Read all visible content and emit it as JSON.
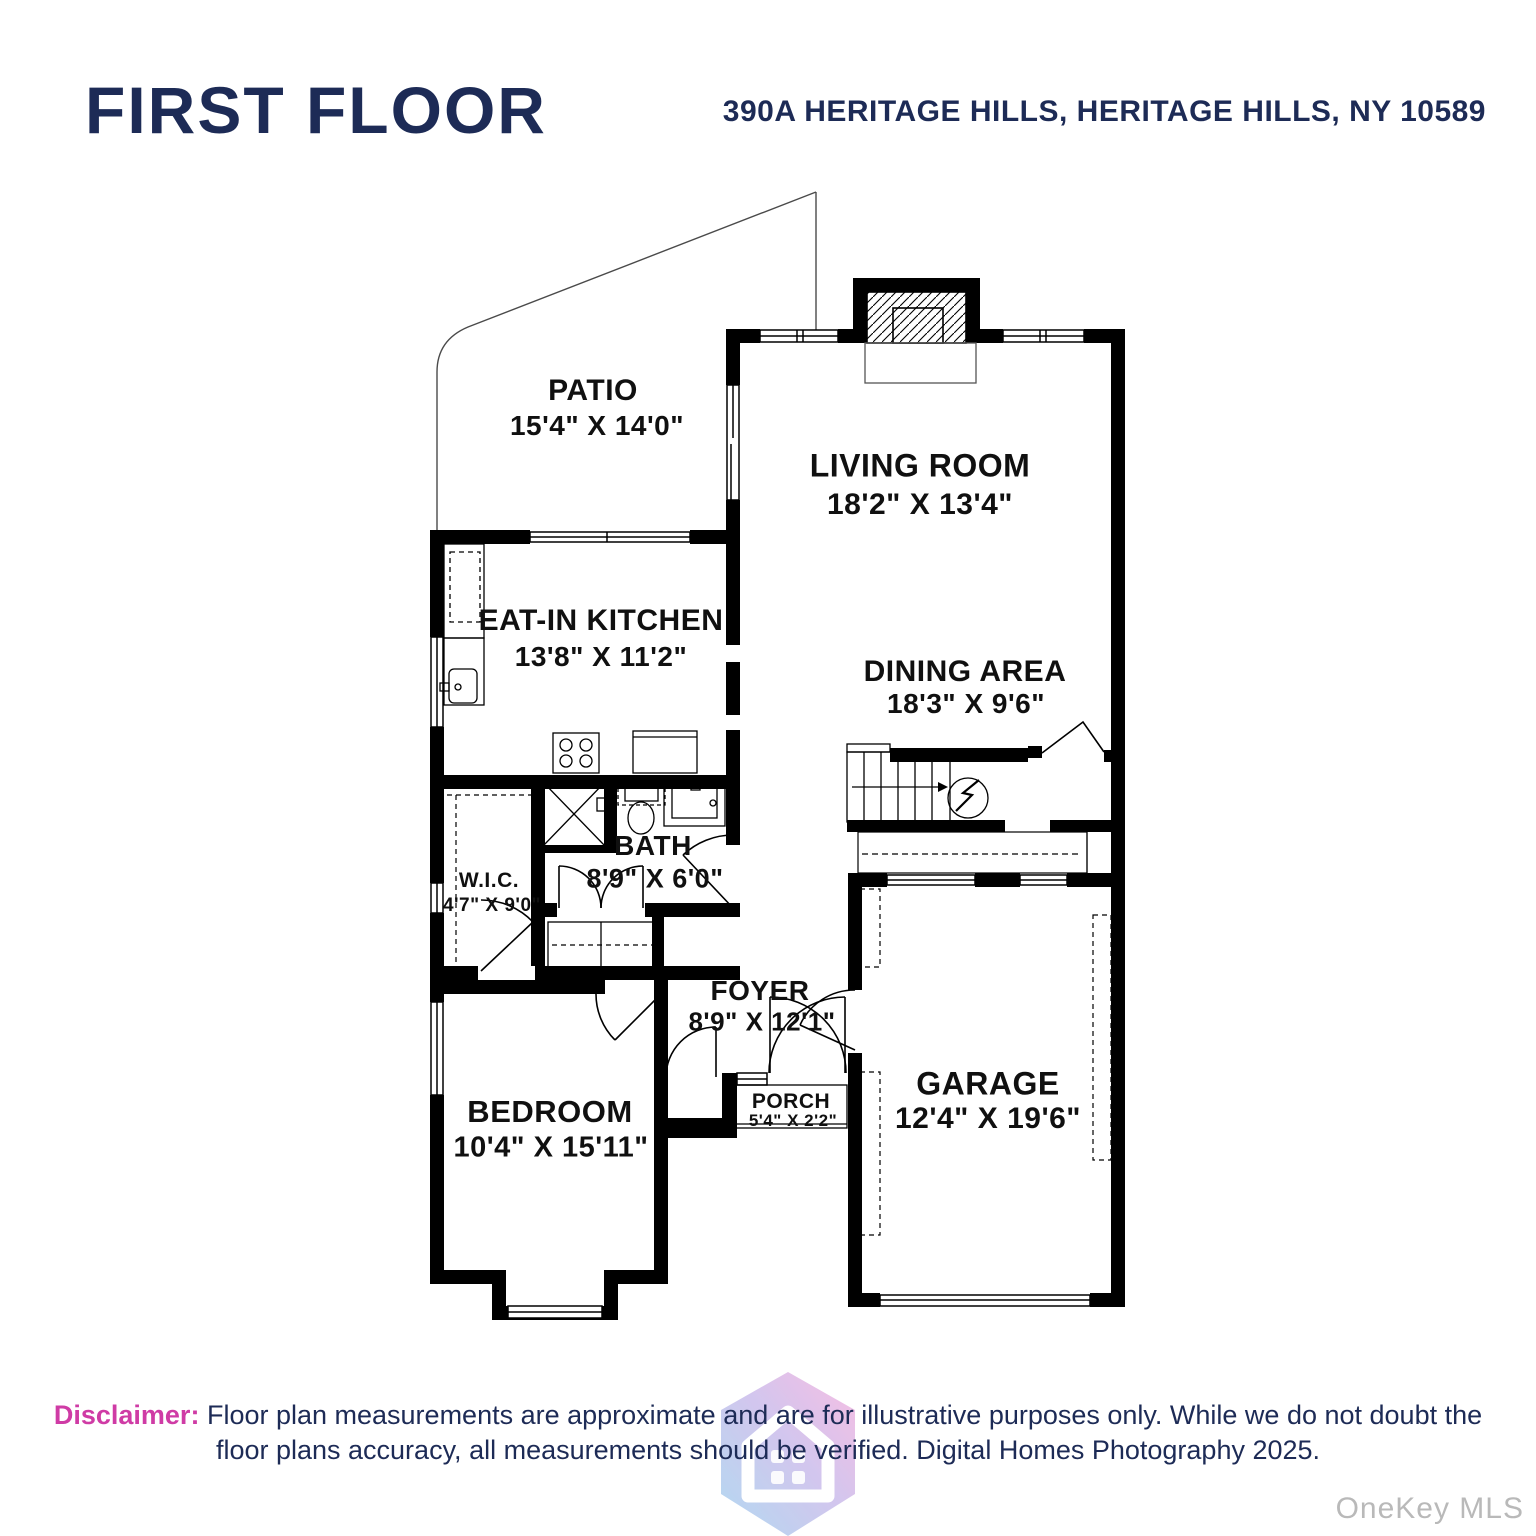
{
  "header": {
    "title": "FIRST FLOOR",
    "address": "390A HERITAGE HILLS, HERITAGE HILLS, NY 10589"
  },
  "rooms": [
    {
      "name": "PATIO",
      "dims": "15'4\" X 14'0\""
    },
    {
      "name": "LIVING ROOM",
      "dims": "18'2\" X 13'4\""
    },
    {
      "name": "EAT-IN KITCHEN",
      "dims": "13'8\" X 11'2\""
    },
    {
      "name": "DINING AREA",
      "dims": "18'3\" X 9'6\""
    },
    {
      "name": "W.I.C.",
      "dims": "4'7\" X 9'0\""
    },
    {
      "name": "BATH",
      "dims": "8'9\" X 6'0\""
    },
    {
      "name": "FOYER",
      "dims": "8'9\" X 12'1\""
    },
    {
      "name": "PORCH",
      "dims": "5'4\" X 2'2\""
    },
    {
      "name": "BEDROOM",
      "dims": "10'4\" X 15'11\""
    },
    {
      "name": "GARAGE",
      "dims": "12'4\" X 19'6\""
    }
  ],
  "footer": {
    "disclaimer_label": "Disclaimer:",
    "disclaimer_line1": "Floor plan measurements are approximate and are for illustrative purposes only. While we do not doubt the",
    "disclaimer_line2": "floor plans accuracy, all measurements should be verified. Digital Homes Photography 2025.",
    "watermark": "OneKey MLS"
  },
  "colors": {
    "navy": "#1d2b56",
    "pink": "#cf3ba5",
    "line": "#000000",
    "watermark_gray": "#b9b9b9",
    "logo_blue": "#9fd0ee",
    "logo_pink": "#f5aedd"
  }
}
